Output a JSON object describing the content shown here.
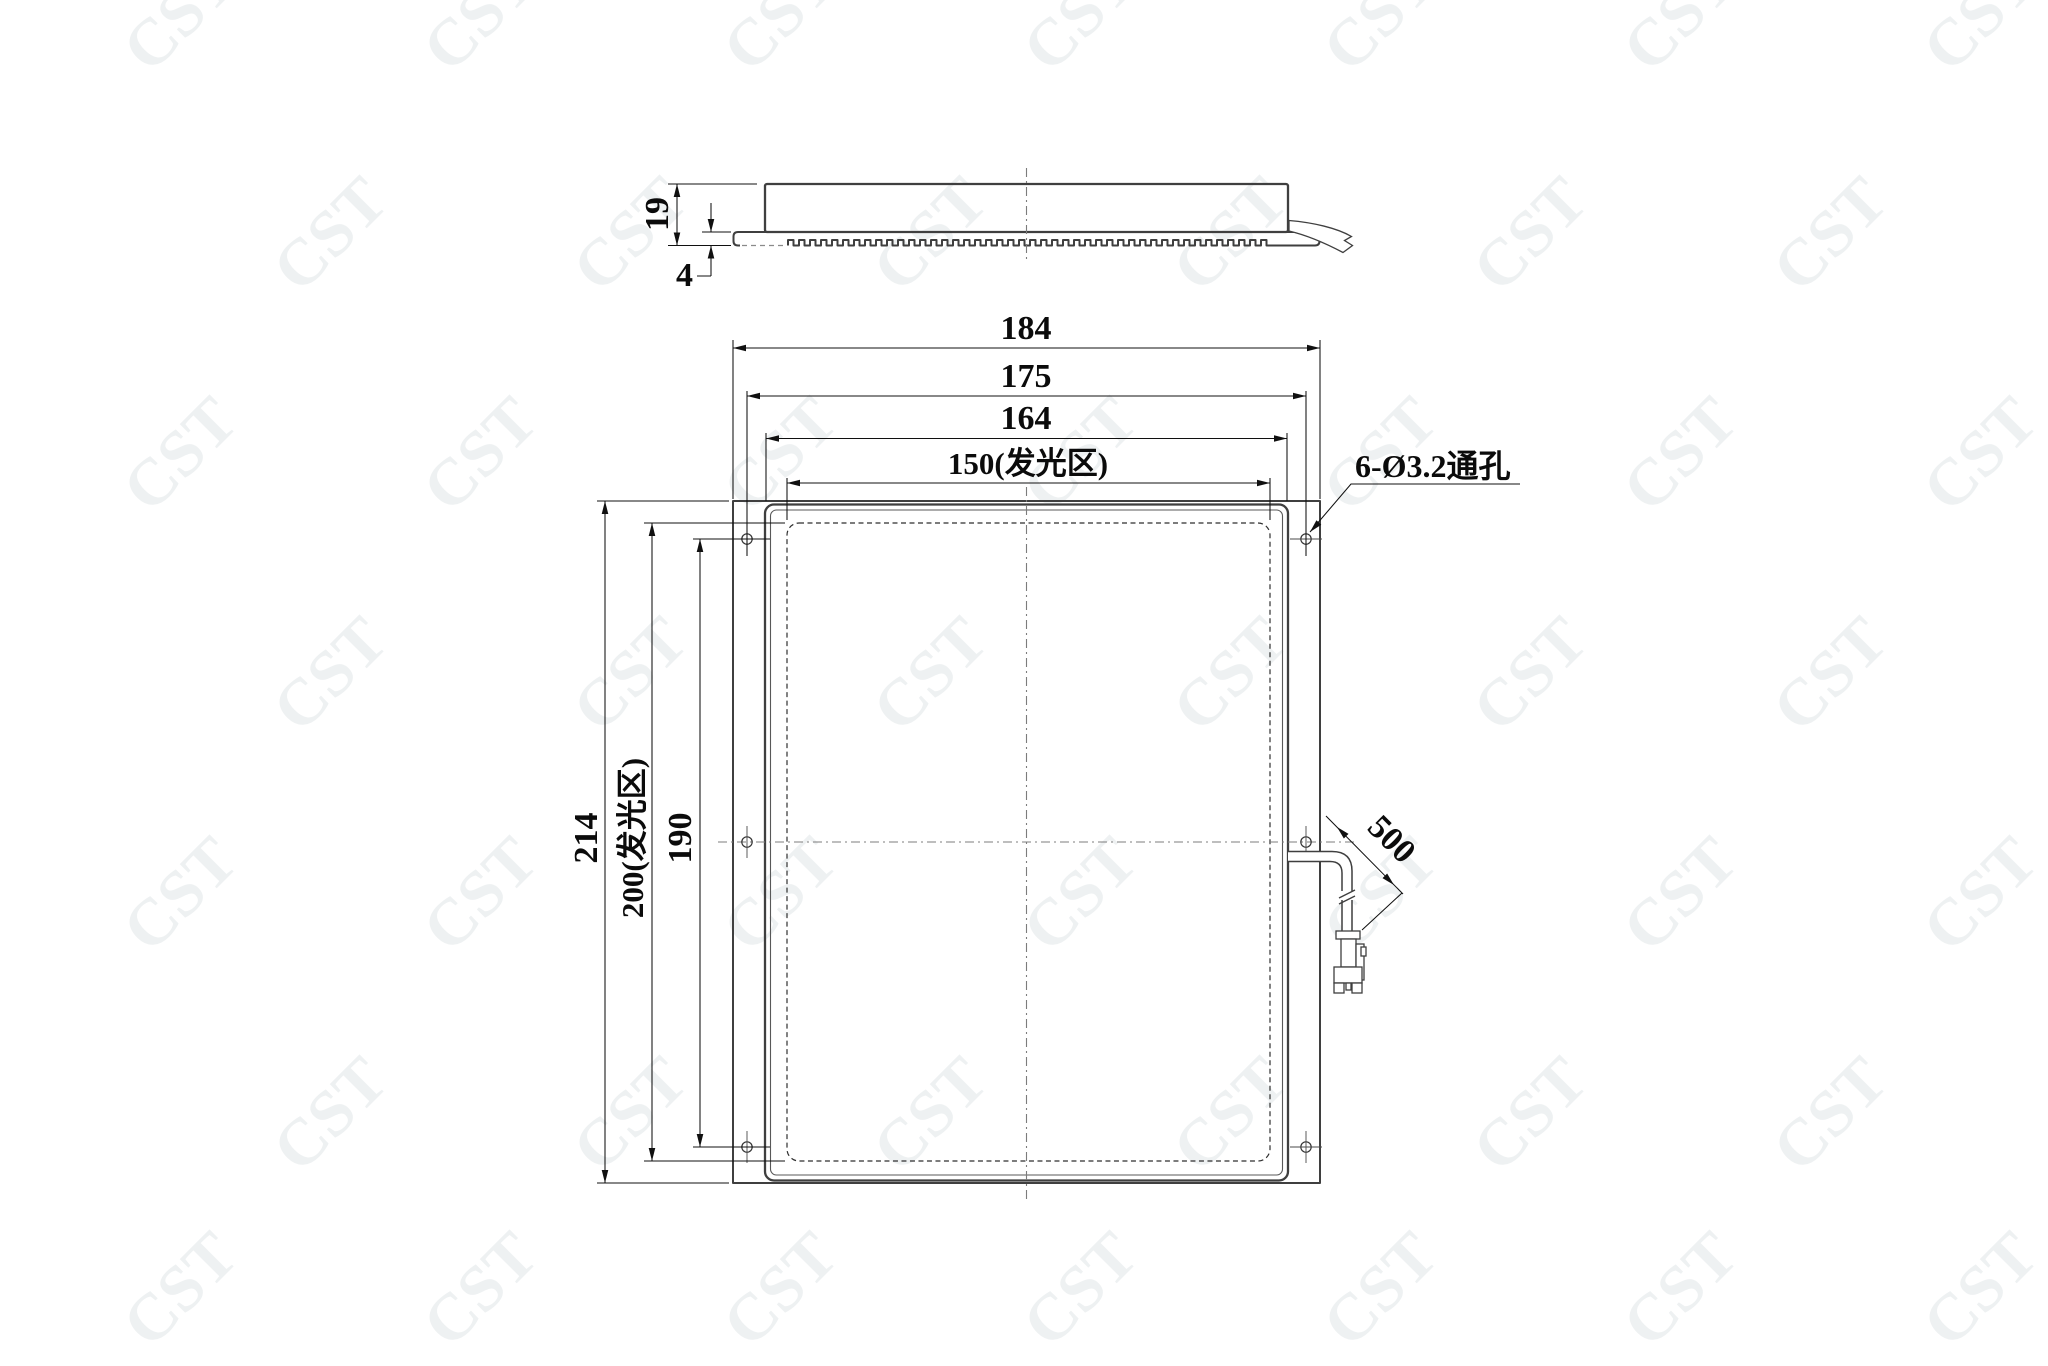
{
  "watermark": {
    "text": "CST"
  },
  "side_view": {
    "total_height": "19",
    "base_plate_thickness": "4"
  },
  "front_view": {
    "overall_width": "184",
    "mounting_hole_pitch_width": "175",
    "body_width": "164",
    "emitting_area_width": "150(发光区)",
    "overall_height": "214",
    "emitting_area_height": "200(发光区)",
    "mounting_hole_pitch_height": "190",
    "cable_length": "500",
    "mounting_hole_callout": "6-Ø3.2通孔"
  }
}
